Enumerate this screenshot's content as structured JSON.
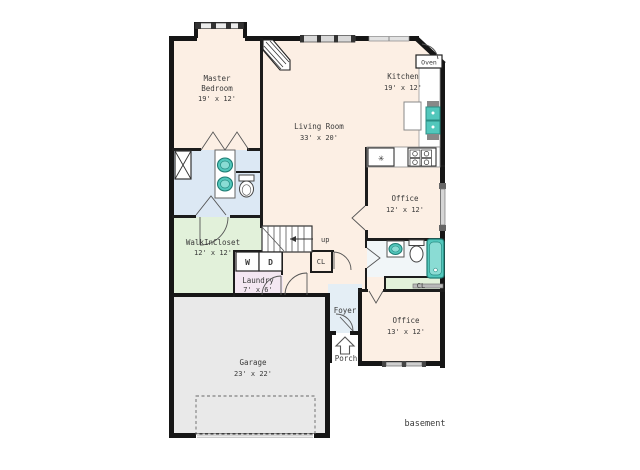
{
  "plan": {
    "rooms": {
      "master_bedroom": {
        "line1": "Master",
        "line2": "Bedroom",
        "dims": "19' x 12'"
      },
      "living_room": {
        "name": "Living Room",
        "dims": "33' x 20'"
      },
      "kitchen": {
        "name": "Kitchen",
        "dims": "19' x 12'"
      },
      "office_upper": {
        "name": "Office",
        "dims": "12' x 12'"
      },
      "office_lower": {
        "name": "Office",
        "dims": "13' x 12'"
      },
      "walk_in_closet": {
        "name": "WalkInCloset",
        "dims": "12' x 12'"
      },
      "laundry": {
        "name": "Laundry",
        "dims": "7' x 6'"
      },
      "garage": {
        "name": "Garage",
        "dims": "23' x 22'"
      },
      "foyer": {
        "name": "Foyer"
      },
      "porch": {
        "name": "Porch"
      }
    },
    "fixtures": {
      "oven": "Oven",
      "washer": "W",
      "dryer": "D",
      "stairs_up": "up",
      "closet_hall": "CL",
      "closet_bath": "CL",
      "basement": "basement"
    },
    "colors": {
      "wall": "#161616",
      "room": "#fcefe4",
      "bath": "#dce8f4",
      "closet": "#e2f1da",
      "laundry": "#f4e7f2",
      "foyer": "#e4eef5",
      "garage": "#e9e9e9",
      "bath2": "#f1f6f8",
      "fixture_teal": "#52c7bc",
      "window": "#d9d9d9"
    }
  }
}
